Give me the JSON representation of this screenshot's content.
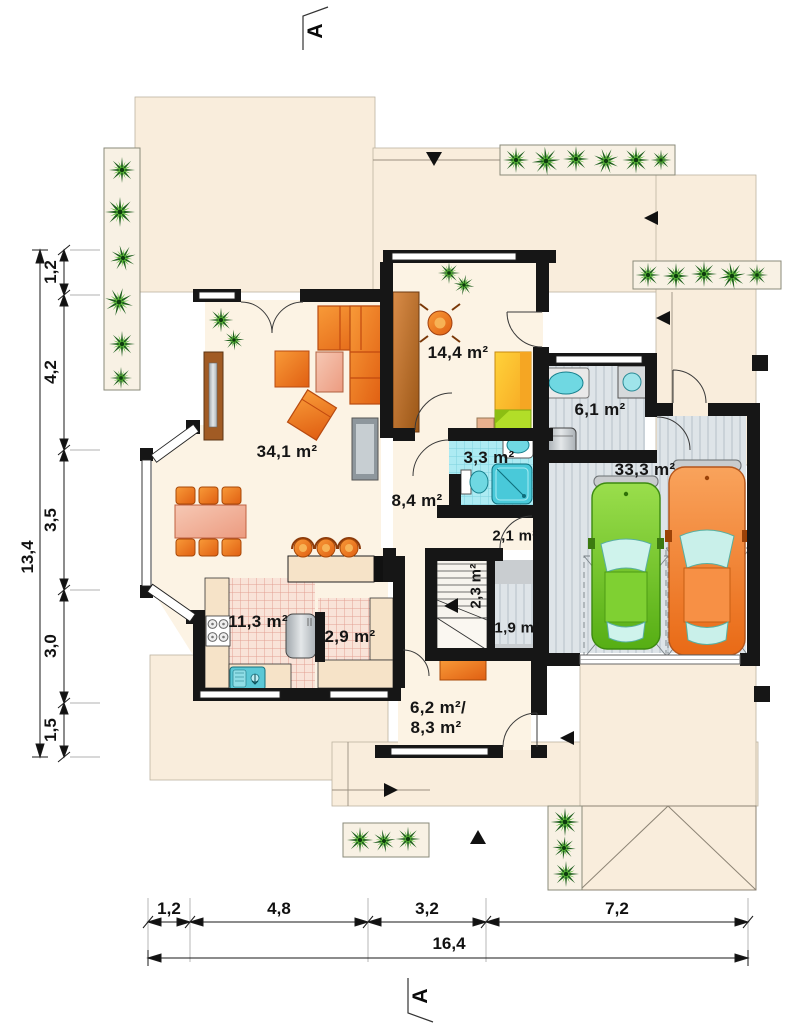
{
  "section": {
    "top": "A",
    "bottom": "A"
  },
  "rooms": {
    "living": "34,1 m²",
    "office": "14,4 m²",
    "hall": "8,4 m²",
    "bath": "3,3 m²",
    "wardrobe": "2,1 m²",
    "stairs": "2,3 m²",
    "storage": "1,9 m²",
    "vestibule_line1": "6,2 m²/",
    "vestibule_line2": "8,3 m²",
    "utility": "6,1 m²",
    "garage": "33,3 m²",
    "kitchen": "11,3 m²",
    "pantry": "2,9 m²"
  },
  "dims": {
    "left_total": "13,4",
    "left": [
      "1,2",
      "4,2",
      "3,5",
      "3,0",
      "1,5"
    ],
    "bottom": [
      "1,2",
      "4,8",
      "3,2",
      "7,2"
    ],
    "bottom_total": "16,4"
  },
  "colors": {
    "wall": "#161616",
    "exterior": "#F9EDDC",
    "interior": "#FCF3E4",
    "kitchen_tile": "#F9E3D8",
    "bath_tile": "#ADEBF3",
    "garage_floor": "#DEE4E8",
    "sofa_orange": "#F0701E",
    "table_salmon": "#F2B49E",
    "car_green": "#6DC620",
    "car_orange": "#F07A28",
    "plant_green": "#5FBE3A"
  }
}
